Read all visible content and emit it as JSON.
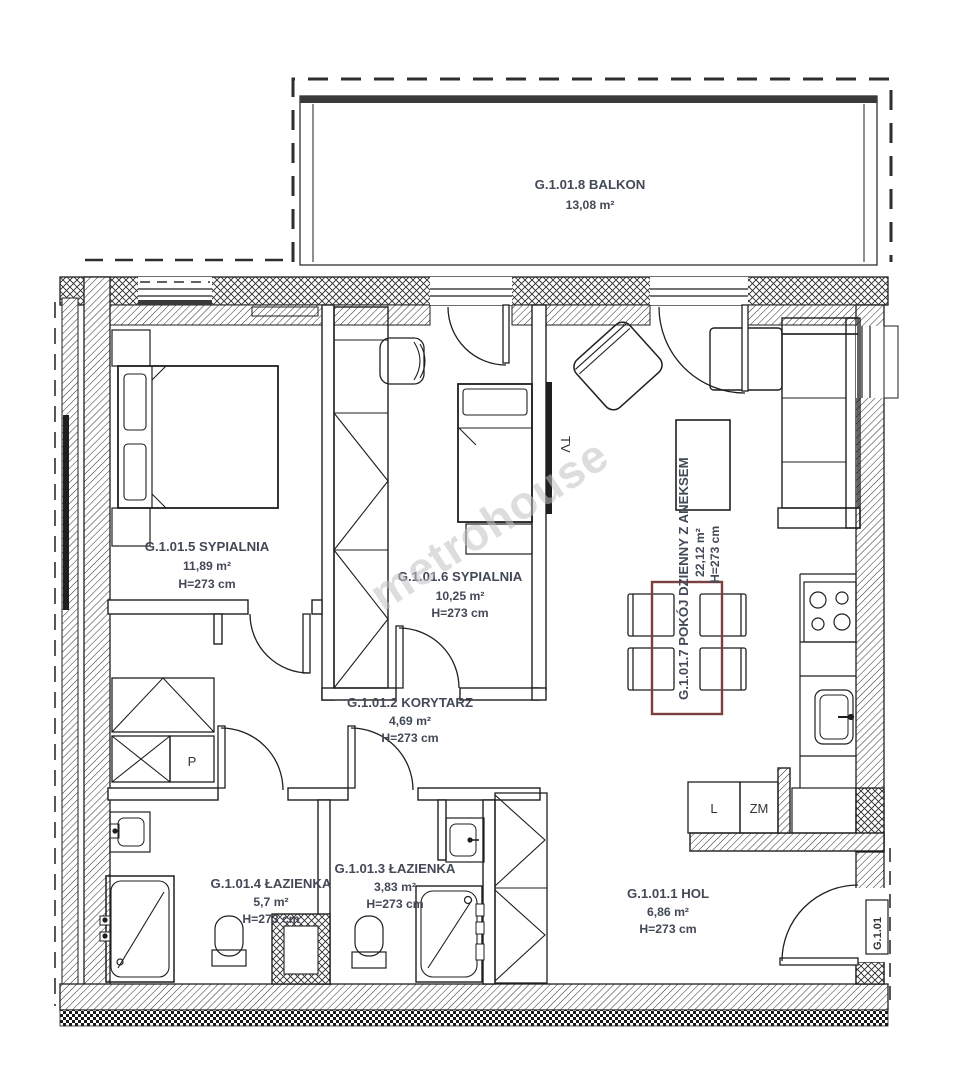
{
  "plan": {
    "labels": {
      "watermark": "metrohouse",
      "unit": "G.1.01",
      "tv": "TV",
      "washer": "P",
      "fridge": "L",
      "dishwasher": "ZM"
    },
    "rooms": {
      "balkon": {
        "name": "G.1.01.8 BALKON",
        "area": "13,08 m²"
      },
      "sypialnia_5": {
        "name": "G.1.01.5 SYPIALNIA",
        "area": "11,89 m²",
        "height": "H=273 cm"
      },
      "sypialnia_6": {
        "name": "G.1.01.6 SYPIALNIA",
        "area": "10,25 m²",
        "height": "H=273 cm"
      },
      "korytarz": {
        "name": "G.1.01.2 KORYTARZ",
        "area": "4,69 m²",
        "height": "H=273 cm"
      },
      "pokoj_dzienny": {
        "name": "G.1.01.7 POKÓJ DZIENNY Z ANEKSEM",
        "area": "22,12 m²",
        "height": "H=273 cm"
      },
      "lazienka_4": {
        "name": "G.1.01.4 ŁAZIENKA",
        "area": "5,7 m²",
        "height": "H=273 cm"
      },
      "lazienka_3": {
        "name": "G.1.01.3 ŁAZIENKA",
        "area": "3,83 m²",
        "height": "H=273 cm"
      },
      "hol": {
        "name": "G.1.01.1 HOL",
        "area": "6,86 m²",
        "height": "H=273 cm"
      }
    },
    "colors": {
      "line": "#1f1f1f",
      "label": "#434957",
      "table_accent": "#7a4040",
      "watermark": "#c2c2c2"
    }
  }
}
